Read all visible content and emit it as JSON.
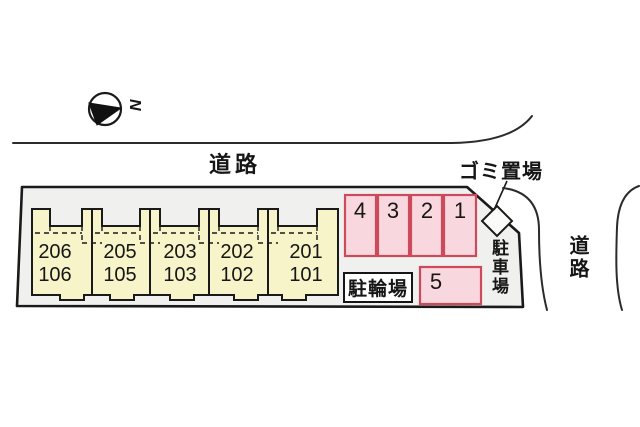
{
  "compass": {
    "letter": "N"
  },
  "roads": {
    "top_label": "道路",
    "side_label": "道路"
  },
  "facilities": {
    "garbage_label": "ゴミ置場",
    "parking_lot_label": "駐車場",
    "bicycle_parking_label": "駐輪場"
  },
  "building": {
    "units": [
      {
        "upper": "206",
        "lower": "106"
      },
      {
        "upper": "205",
        "lower": "105"
      },
      {
        "upper": "203",
        "lower": "103"
      },
      {
        "upper": "202",
        "lower": "102"
      },
      {
        "upper": "201",
        "lower": "101"
      }
    ]
  },
  "parking": {
    "stalls": [
      "4",
      "3",
      "2",
      "1"
    ],
    "stall5_label": "5"
  },
  "colors": {
    "plot_fill": "#f0f0ee",
    "unit_fill": "#f8f4ca",
    "stall_fill": "#f9d7de",
    "stall_border": "#cc4a5c",
    "outline": "#1a1a1a",
    "road_line": "#2b2b2b"
  }
}
